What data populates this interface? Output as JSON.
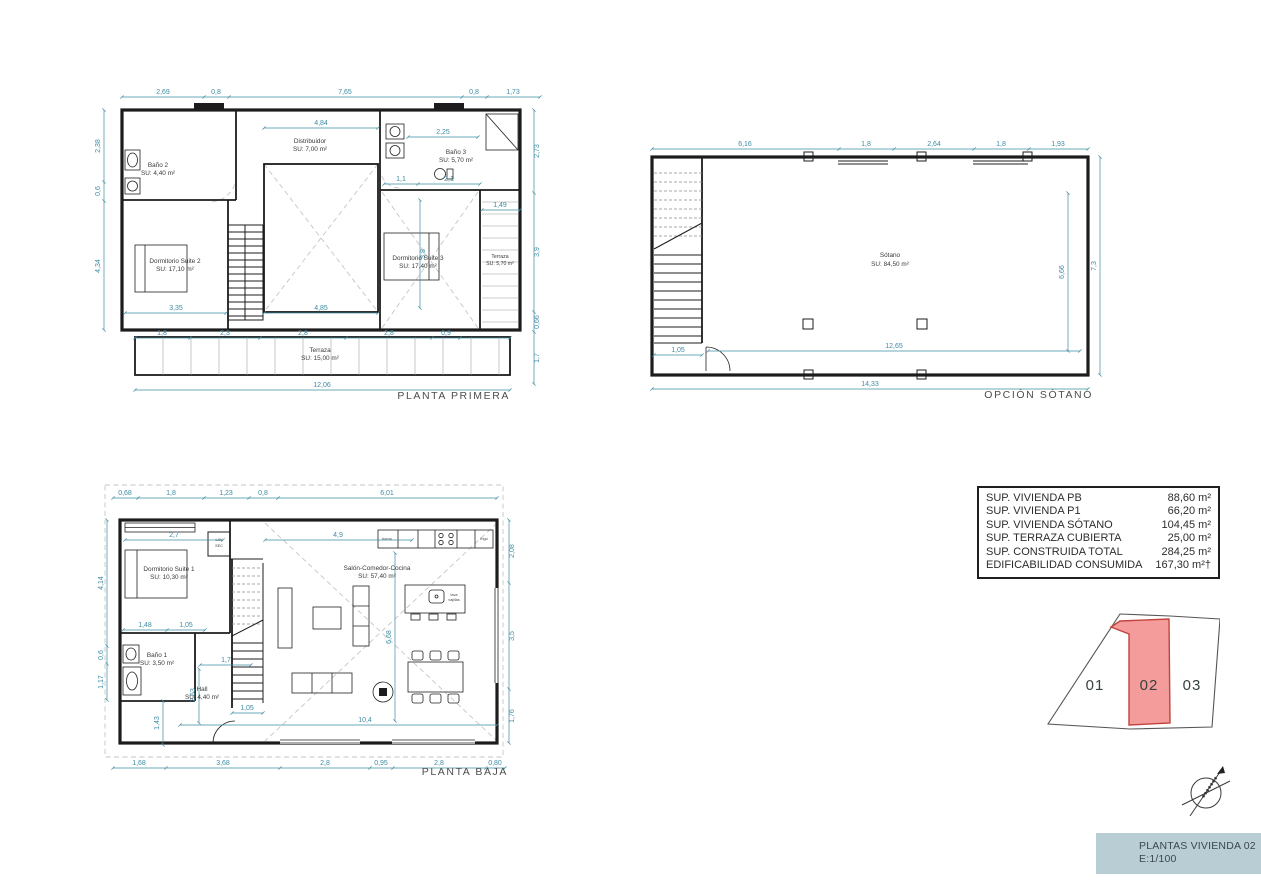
{
  "titles": {
    "primera": "PLANTA PRIMERA",
    "sotano": "OPCIÓN SÓTANO",
    "baja": "PLANTA BAJA"
  },
  "plans": {
    "primera": {
      "rooms": {
        "bano2": {
          "name": "Baño 2",
          "area": "SU: 4,40 m²"
        },
        "suite2": {
          "name": "Dormitorio Suite 2",
          "area": "SU: 17,10 m²"
        },
        "distribuidor": {
          "name": "Distribuidor",
          "area": "SU: 7,00 m²"
        },
        "bano3": {
          "name": "Baño 3",
          "area": "SU: 5,70 m²"
        },
        "suite3": {
          "name": "Dormitorio Suite 3",
          "area": "SU: 17,40 m²"
        },
        "terraza_lateral": {
          "name": "Terraza",
          "area": "SU: 5,70 m²"
        },
        "terraza": {
          "name": "Terraza",
          "area": "SU: 15,00 m²"
        }
      },
      "dims": {
        "top": [
          "2,69",
          "0,8",
          "7,65",
          "0,8",
          "1,73"
        ],
        "left": [
          "2,38",
          "0,6",
          "4,34"
        ],
        "right": [
          "2,73",
          "3,9",
          "0,66",
          "1,7"
        ],
        "bottom": "12,06",
        "terrace": [
          "1,8",
          "2,3",
          "2,8",
          "2,8",
          "0,9"
        ],
        "inner": {
          "distribuidor_w": "4,84",
          "hall1": "1,1",
          "hall2": "2,1",
          "suite2_w": "3,35",
          "void_w": "4,85",
          "bano3_w": "2,25",
          "terraza_w": "1,49",
          "suite3_h": "3,8"
        }
      }
    },
    "sotano": {
      "rooms": {
        "sotano": {
          "name": "Sótano",
          "area": "SU: 84,50 m²"
        }
      },
      "dims": {
        "top": [
          "6,16",
          "1,8",
          "2,64",
          "1,8",
          "1,93"
        ],
        "right": "7,3",
        "inner_v": "6,66",
        "bottom": "14,33",
        "inner_h": "12,65",
        "stairs": "1,05"
      }
    },
    "baja": {
      "rooms": {
        "suite1": {
          "name": "Dormitorio Suite 1",
          "area": "SU: 10,30 m²"
        },
        "bano1": {
          "name": "Baño 1",
          "area": "SU: 3,50 m²"
        },
        "hall": {
          "name": "Hall",
          "area": "SU: 4,40 m²"
        },
        "salon": {
          "name": "Salón-Comedor-Cocina",
          "area": "SU: 57,40 m²"
        }
      },
      "labels": {
        "lav1": "LAV",
        "lav2": "SEC",
        "horno": "horno",
        "frigo": "frigo",
        "lava1": "lava",
        "lava2": "vajillas"
      },
      "dims": {
        "top": [
          "0,68",
          "1,8",
          "1,23",
          "0,8",
          "6,01"
        ],
        "bottom": [
          "1,68",
          "3,68",
          "2,8",
          "0,95",
          "2,8",
          "0,80"
        ],
        "right": [
          "2,08",
          "3,5",
          "1,76"
        ],
        "left": [
          "4,14",
          "0,6",
          "1,17"
        ],
        "inner": {
          "suite1_w": "2,7",
          "salon_w": "4,9",
          "bano_w": "1,48",
          "closet": "1,05",
          "hall_w": "1,7",
          "hall_h": "2,53",
          "porch": "1,43",
          "stairs_w": "1,05",
          "salon_total": "10,4",
          "salon_h": "6,68"
        }
      }
    }
  },
  "area_table": {
    "rows": [
      {
        "label": "SUP. VIVIENDA PB",
        "value": "88,60 m²"
      },
      {
        "label": "SUP. VIVIENDA P1",
        "value": "66,20 m²"
      },
      {
        "label": "SUP. VIVIENDA SÓTANO",
        "value": "104,45 m²"
      },
      {
        "label": "SUP. TERRAZA CUBIERTA",
        "value": "25,00 m²"
      },
      {
        "label": "SUP. CONSTRUIDA TOTAL",
        "value": "284,25 m²"
      },
      {
        "label": "EDIFICABILIDAD CONSUMIDA",
        "value": "167,30 m²†"
      }
    ]
  },
  "plot": {
    "lot1": "01",
    "lot2": "02",
    "lot3": "03"
  },
  "titleblock": {
    "line1": "PLANTAS VIVIENDA 02",
    "line2": "E:1/100"
  },
  "colors": {
    "dimension": "#3e8ca3",
    "wall": "#1c1c1c",
    "highlight_fill": "#f49c9c",
    "highlight_stroke": "#c0443c",
    "titleblock_bg": "#b9cdd5"
  }
}
